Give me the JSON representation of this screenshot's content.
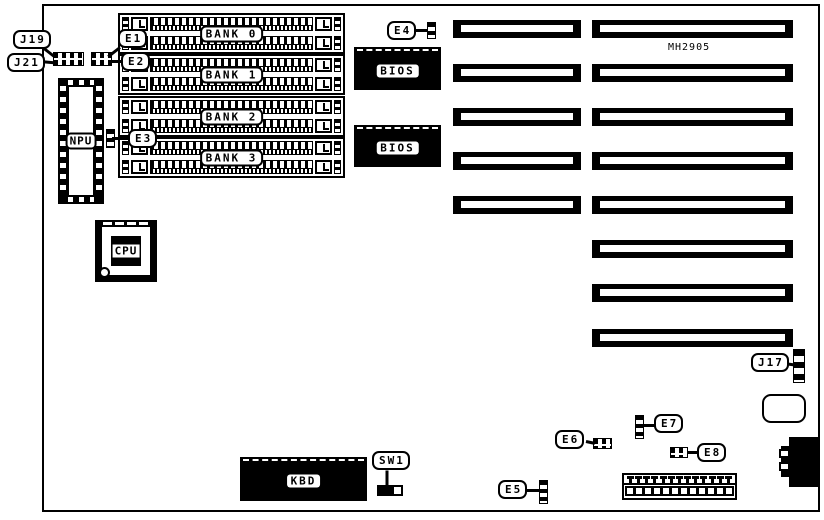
{
  "board": {
    "model": "MH2905"
  },
  "memory_banks": [
    {
      "label": "BANK 0"
    },
    {
      "label": "BANK 1"
    },
    {
      "label": "BANK 2"
    },
    {
      "label": "BANK 3"
    }
  ],
  "chips": {
    "bios_top": {
      "label": "BIOS"
    },
    "bios_bottom": {
      "label": "BIOS"
    },
    "keyboard": {
      "label": "KBD"
    }
  },
  "sockets": {
    "npu": {
      "label": "NPU"
    },
    "cpu": {
      "label": "CPU"
    }
  },
  "callouts": {
    "j19": {
      "label": "J19"
    },
    "j21": {
      "label": "J21"
    },
    "j17": {
      "label": "J17"
    },
    "e1": {
      "label": "E1"
    },
    "e2": {
      "label": "E2"
    },
    "e3": {
      "label": "E3"
    },
    "e4": {
      "label": "E4"
    },
    "e5": {
      "label": "E5"
    },
    "e6": {
      "label": "E6"
    },
    "e7": {
      "label": "E7"
    },
    "e8": {
      "label": "E8"
    },
    "sw1": {
      "label": "SW1"
    }
  },
  "expansion_slots": {
    "short_count": 5,
    "long_count": 8
  },
  "colors": {
    "foreground": "#000000",
    "background": "#ffffff"
  }
}
